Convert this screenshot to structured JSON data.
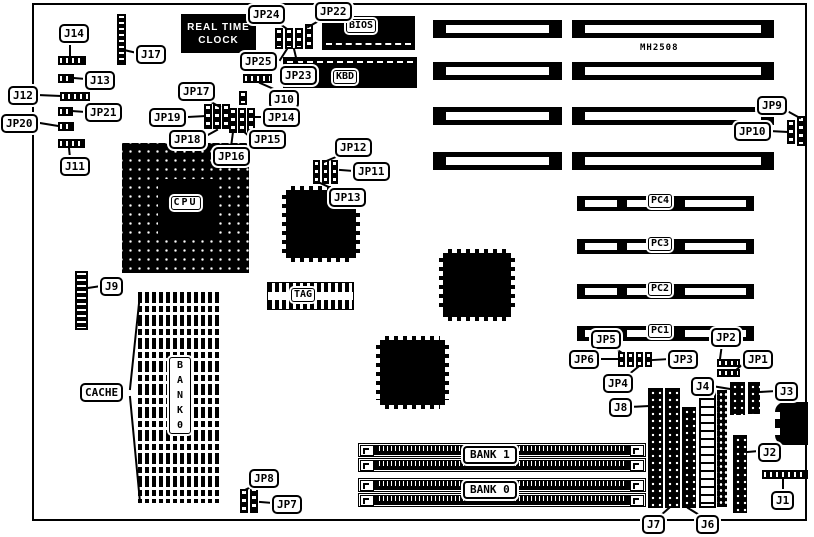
{
  "board": {
    "model_text": "MH2508"
  },
  "colors": {
    "ink": "#000000",
    "paper": "#ffffff"
  },
  "chips": {
    "rtc": "REAL TIME\nCLOCK",
    "bios": "BIOS",
    "kbd": "KBD",
    "cpu": "CPU",
    "tag": "TAG",
    "cache_bank_vertical": "B\nA\nN\nK\n0",
    "simm_bank1": "BANK 1",
    "simm_bank0": "BANK 0"
  },
  "pci_slots": [
    {
      "label": "PC4"
    },
    {
      "label": "PC3"
    },
    {
      "label": "PC2"
    },
    {
      "label": "PC1"
    }
  ],
  "callouts": [
    {
      "text": "J14",
      "x": 59,
      "y": 24,
      "lines": [
        [
          70,
          41,
          70,
          55
        ]
      ]
    },
    {
      "text": "J17",
      "x": 136,
      "y": 45,
      "lines": [
        [
          137,
          53,
          124,
          50
        ]
      ]
    },
    {
      "text": "J13",
      "x": 85,
      "y": 71,
      "lines": [
        [
          86,
          79,
          73,
          78
        ]
      ]
    },
    {
      "text": "J12",
      "x": 8,
      "y": 86,
      "lines": [
        [
          38,
          95,
          60,
          96
        ]
      ]
    },
    {
      "text": "JP21",
      "x": 85,
      "y": 103,
      "lines": [
        [
          86,
          112,
          71,
          111
        ]
      ]
    },
    {
      "text": "JP20",
      "x": 1,
      "y": 114,
      "lines": [
        [
          40,
          123,
          58,
          126
        ]
      ]
    },
    {
      "text": "J11",
      "x": 60,
      "y": 157,
      "lines": [
        [
          70,
          158,
          69,
          148
        ]
      ]
    },
    {
      "text": "JP24",
      "x": 248,
      "y": 5,
      "lines": [
        [
          276,
          21,
          287,
          29
        ]
      ]
    },
    {
      "text": "JP22",
      "x": 315,
      "y": 2,
      "lines": [
        [
          324,
          18,
          308,
          27
        ]
      ]
    },
    {
      "text": "JP25",
      "x": 240,
      "y": 52,
      "lines": [
        [
          280,
          60,
          287,
          49
        ]
      ]
    },
    {
      "text": "JP23",
      "x": 280,
      "y": 66,
      "lines": [
        [
          298,
          66,
          294,
          49
        ]
      ]
    },
    {
      "text": "J10",
      "x": 269,
      "y": 90,
      "lines": [
        [
          276,
          90,
          260,
          83
        ]
      ]
    },
    {
      "text": "JP17",
      "x": 178,
      "y": 82,
      "lines": [
        [
          204,
          98,
          220,
          107
        ]
      ]
    },
    {
      "text": "JP19",
      "x": 149,
      "y": 108,
      "lines": [
        [
          188,
          117,
          205,
          116
        ]
      ]
    },
    {
      "text": "JP18",
      "x": 169,
      "y": 130,
      "lines": [
        [
          206,
          136,
          217,
          130
        ]
      ]
    },
    {
      "text": "JP16",
      "x": 213,
      "y": 147,
      "lines": [
        [
          231,
          147,
          233,
          132
        ]
      ]
    },
    {
      "text": "JP15",
      "x": 249,
      "y": 130,
      "lines": [
        [
          250,
          137,
          242,
          130
        ]
      ]
    },
    {
      "text": "JP14",
      "x": 263,
      "y": 108,
      "lines": [
        [
          264,
          117,
          253,
          117
        ]
      ]
    },
    {
      "text": "JP12",
      "x": 335,
      "y": 138,
      "lines": [
        [
          343,
          154,
          324,
          162
        ]
      ]
    },
    {
      "text": "JP11",
      "x": 353,
      "y": 162,
      "lines": [
        [
          354,
          171,
          340,
          170
        ]
      ]
    },
    {
      "text": "JP13",
      "x": 329,
      "y": 188,
      "lines": [
        [
          333,
          189,
          318,
          182
        ]
      ]
    },
    {
      "text": "J9",
      "x": 100,
      "y": 277,
      "lines": [
        [
          101,
          286,
          88,
          288
        ]
      ]
    },
    {
      "text": "JP9",
      "x": 757,
      "y": 96,
      "lines": [
        [
          789,
          112,
          800,
          118
        ]
      ]
    },
    {
      "text": "JP10",
      "x": 734,
      "y": 122,
      "lines": [
        [
          770,
          131,
          787,
          132
        ]
      ]
    },
    {
      "text": "JP5",
      "x": 591,
      "y": 330,
      "lines": [
        [
          612,
          346,
          622,
          353
        ]
      ]
    },
    {
      "text": "JP2",
      "x": 711,
      "y": 328,
      "lines": [
        [
          722,
          344,
          720,
          359
        ]
      ]
    },
    {
      "text": "JP6",
      "x": 569,
      "y": 350,
      "lines": [
        [
          598,
          359,
          617,
          359
        ]
      ]
    },
    {
      "text": "JP3",
      "x": 668,
      "y": 350,
      "lines": [
        [
          669,
          359,
          653,
          360
        ]
      ]
    },
    {
      "text": "JP4",
      "x": 603,
      "y": 374,
      "lines": [
        [
          628,
          375,
          638,
          367
        ]
      ]
    },
    {
      "text": "JP1",
      "x": 743,
      "y": 350,
      "lines": [
        [
          744,
          363,
          735,
          371
        ]
      ]
    },
    {
      "text": "J4",
      "x": 691,
      "y": 377,
      "lines": [
        [
          712,
          386,
          730,
          389
        ]
      ]
    },
    {
      "text": "J3",
      "x": 775,
      "y": 382,
      "lines": [
        [
          776,
          391,
          760,
          392
        ]
      ]
    },
    {
      "text": "J8",
      "x": 609,
      "y": 398,
      "lines": [
        [
          630,
          407,
          648,
          406
        ]
      ]
    },
    {
      "text": "J2",
      "x": 758,
      "y": 443,
      "lines": [
        [
          759,
          451,
          747,
          452
        ]
      ]
    },
    {
      "text": "J1",
      "x": 771,
      "y": 491,
      "lines": [
        [
          783,
          492,
          783,
          479
        ]
      ]
    },
    {
      "text": "J7",
      "x": 642,
      "y": 515,
      "lines": [
        [
          660,
          516,
          669,
          508
        ]
      ]
    },
    {
      "text": "J6",
      "x": 696,
      "y": 515,
      "lines": [
        [
          701,
          516,
          688,
          508
        ]
      ]
    },
    {
      "text": "JP8",
      "x": 249,
      "y": 469,
      "lines": [
        [
          255,
          485,
          245,
          490
        ]
      ]
    },
    {
      "text": "JP7",
      "x": 272,
      "y": 495,
      "lines": [
        [
          273,
          503,
          260,
          502
        ]
      ]
    },
    {
      "text": "CACHE",
      "x": 80,
      "y": 383,
      "lines": [
        [
          130,
          389,
          140,
          294
        ],
        [
          130,
          397,
          140,
          502
        ]
      ]
    }
  ]
}
